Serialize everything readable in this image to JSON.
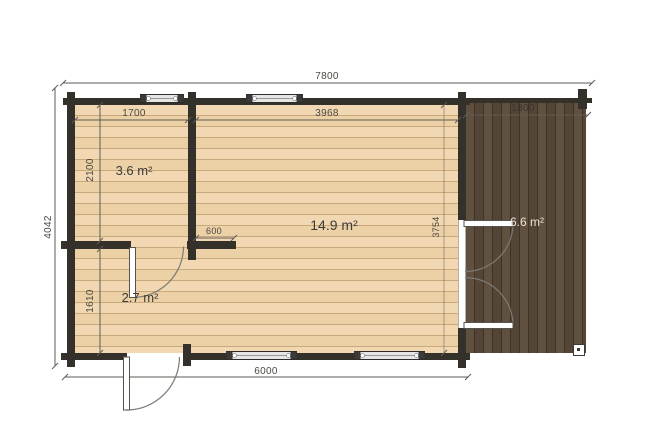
{
  "dims": {
    "total_width": "7800",
    "room_small_width": "1700",
    "room_main_width": "3968",
    "terrace_width": "1800",
    "total_depth": "4042",
    "room_small_depth": "2100",
    "room_entry_depth": "1610",
    "wall_return": "600",
    "room_main_depth": "3754",
    "cabin_width": "6000"
  },
  "areas": {
    "room_small": "3.6 m²",
    "room_main": "14.9 m²",
    "room_entry": "2.7 m²",
    "terrace": "6.6 m²"
  },
  "colors": {
    "wall": "#34312b",
    "floor_light": "#eed3ab",
    "floor_light_seam": "#c9a87c",
    "floor_dark": "#5a4a3d",
    "floor_dark_seam": "#3e3228",
    "dim_line": "#5f5b55",
    "dim_text": "#4a4742",
    "dim_text_dark_bg": "#3b352d",
    "label_text": "#3d3b38",
    "label_text_on_dark": "#eae4da",
    "window_fill": "#e6e6e6",
    "window_frame": "#2e2c28",
    "door_leaf": "#ffffff",
    "door_stroke": "#55534e",
    "arc": "#7d7a74",
    "post_border": "#3a3a38"
  }
}
